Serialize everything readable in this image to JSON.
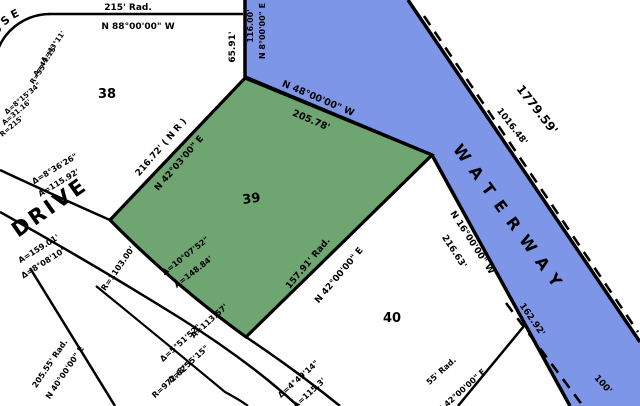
{
  "lots": {
    "lot_nw": "38",
    "lot_center": "39",
    "lot_se": "40"
  },
  "streets": {
    "drive": "DRIVE",
    "close": "CLOSE"
  },
  "waterway": {
    "name": "WATERWAY"
  },
  "colors": {
    "water": "#7e96e8",
    "parcel_highlight": "#6fa570",
    "line": "#000000",
    "background": "#ffffff"
  },
  "labels": {
    "rad215": "215' Rad.",
    "brg_top": "N 88°00'00\" W",
    "d6591": "65.91'",
    "d116": "116.00'",
    "brg_n8": "N 8°00'00\" E",
    "d1779": "1779.59'",
    "d1016": "1016.48'",
    "brg_n48": "N 48°00'00\" W",
    "d20578": "205.78'",
    "d21672": "216.72' ( N R )",
    "brg_n4203": "N 42°03'00\" E",
    "d15791": "157.91' Rad.",
    "brg_n4200": "N 42°00'00\" E",
    "delta1007": "Δ=10°07'52\"",
    "a14884": "A=148.84'",
    "delta836": "Δ=8°36'26\"",
    "a11592": "A=115.92'",
    "r1103": "R=1103.00'",
    "a15901": "A=159.01'",
    "delta808": "Δ=8°08'10\"",
    "rad20555": "205.55' Rad.",
    "brg_n40": "N 40°00'00\" E",
    "a11357": "A=113.57'",
    "delta551": "Δ=5°51'52\"",
    "delta855": "Δ=8°55'15\"",
    "r972": "R=972.62'",
    "delta449": "Δ=4°49'14\"",
    "a1153": "A=115.3'",
    "rad55": "55' Rad.",
    "brg_bot": "N 42°00'00\" E",
    "c1a": "Δ=43°11'",
    "c1b": "A=41.15'",
    "c1c": "R=55'",
    "c2a": "Δ=8°15'34\"",
    "c2b": "A=31.16'",
    "c2c": "R=215'",
    "brg_n16": "N 16°00'00\" W",
    "d21663": "216.63'",
    "d16292": "162.92'",
    "d100": "100'"
  }
}
